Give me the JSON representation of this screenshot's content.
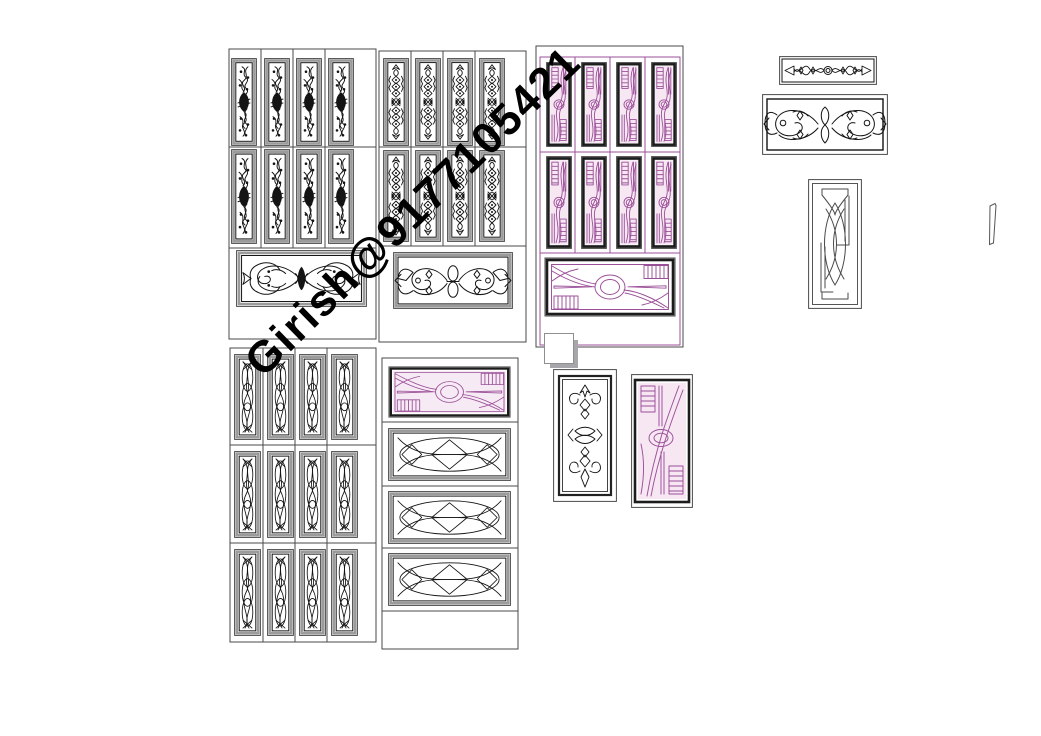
{
  "watermark": {
    "text": "Girish@9177105421",
    "color": "#000000"
  },
  "palette": {
    "background": "#ffffff",
    "line": "#4a4a4a",
    "ink": "#141414",
    "bevel": "#9b9b9b",
    "magenta": "#9b4f98",
    "frame_dark": "#1c1c1c",
    "magenta_fill": "#f6e7f3",
    "shadow_gray": "#a7a7ab",
    "watermark": "#000000"
  },
  "sheet": {
    "type": "carved-door-panel-design-drawing",
    "door_top_left": {
      "vertical_panels": 8,
      "horizontal_panels": 1,
      "panel_style": "carved-scroll"
    },
    "door_top_middle": {
      "vertical_panels": 8,
      "horizontal_panels": 1,
      "panel_style": "carved-floral"
    },
    "door_top_right_magenta": {
      "vertical_panels": 8,
      "horizontal_panels": 1,
      "panel_style": "modern-curve"
    },
    "strip_small": {
      "horizontal_panels": 1,
      "panel_style": "carved-strip"
    },
    "strip_large": {
      "horizontal_panels": 1,
      "panel_style": "carved-strip"
    },
    "arcs_panel": {
      "vertical_panels": 1,
      "panel_style": "interlocking-arcs"
    },
    "door_bottom_left": {
      "vertical_panels": 12,
      "panel_style": "woven-lattice"
    },
    "door_bottom_middle": {
      "horizontal_panels": 4,
      "panel_style": "lattice-and-modern-curve"
    },
    "ornate_vertical_panel": {
      "vertical_panels": 1,
      "panel_style": "carved-floral"
    },
    "modern_vertical_panel": {
      "vertical_panels": 1,
      "panel_style": "modern-curve"
    }
  }
}
